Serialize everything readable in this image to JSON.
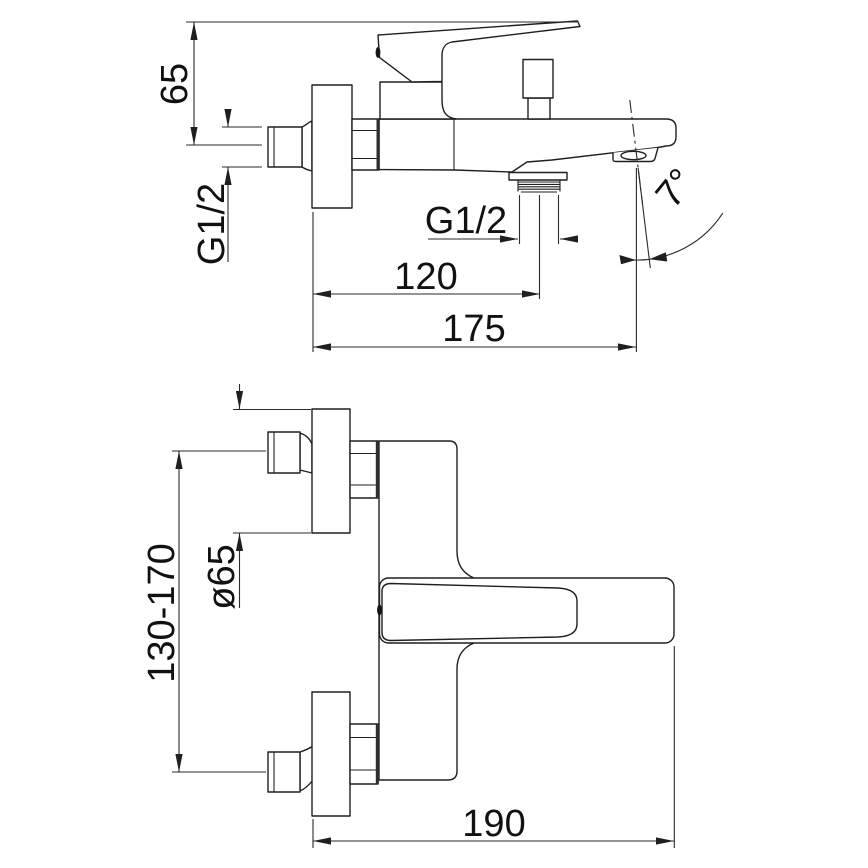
{
  "drawing": {
    "title": "bath-mixer-installation-dimensions",
    "line_color": "#1f1f1f",
    "background_color": "#ffffff",
    "side_view": {
      "dims": {
        "height_to_spout_tip": "65",
        "inlet_thread": "G1/2",
        "outlet_thread": "G1/2",
        "wall_to_outlet": "120",
        "wall_to_spout_tip": "175",
        "spout_angle": "7°"
      }
    },
    "plan_view": {
      "dims": {
        "escutcheon_diameter": "ø65",
        "inlet_spacing": "130-170",
        "wall_to_front": "190"
      }
    }
  }
}
